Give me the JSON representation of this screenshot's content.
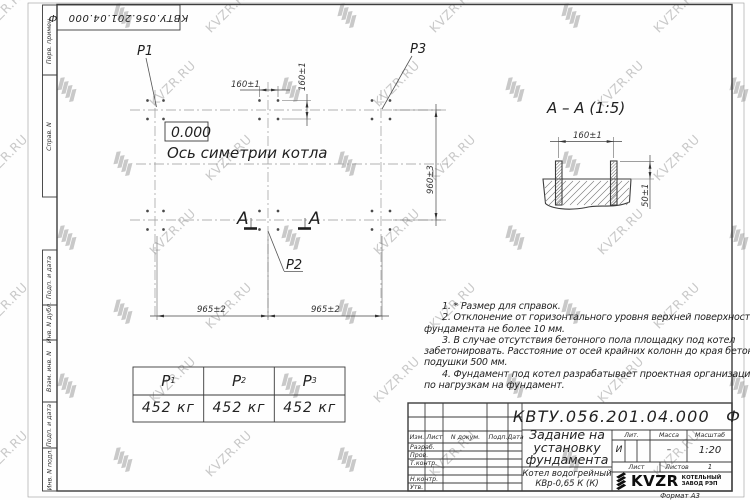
{
  "watermark": {
    "text": "KVZR.RU",
    "color": "#c9c9c9"
  },
  "corner_stamp": {
    "text": "КВТУ.056.201.04.000 Ф"
  },
  "margin": {
    "labels": [
      "Перв. примен.",
      "Справ. N",
      "Подп. и дата",
      "Инв. N дубл.",
      "Взам. инв. N",
      "Подп. и дата",
      "Инв. N подл."
    ]
  },
  "plan": {
    "point_labels": {
      "p1": "P1",
      "p2": "P2",
      "p3": "P3"
    },
    "elevation": "0.000",
    "axis_label": "Ось симетрии котла",
    "dims": {
      "bolt_x": "160±1",
      "bolt_y": "160±1",
      "height": "960±3",
      "span_left": "965±2",
      "span_right": "965±2"
    },
    "section_letter": "A"
  },
  "section_view": {
    "title": "A – A (1:5)",
    "dims": {
      "bolt_spacing": "160±1",
      "protrusion": "50±1"
    }
  },
  "notes": {
    "lines": [
      {
        "text": "1. * Размер для справок.",
        "indent": true
      },
      {
        "text": "2. Отклонение от горизонтального уровня верхней поверхности",
        "indent": true
      },
      {
        "text": "фундамента не более 10 мм.",
        "indent": false
      },
      {
        "text": "3. В случае отсутствия бетонного пола площадку под котел",
        "indent": true
      },
      {
        "text": "забетонировать. Расстояние от осей крайних колонн до края бетонной",
        "indent": false
      },
      {
        "text": "подушки 500 мм.",
        "indent": false
      },
      {
        "text": "4. Фундамент под котел разрабатывает проектная организация",
        "indent": true
      },
      {
        "text": "по нагрузкам на фундамент.",
        "indent": false
      }
    ]
  },
  "load_table": {
    "headers": [
      {
        "base": "P",
        "sub": "1"
      },
      {
        "base": "P",
        "sub": "2"
      },
      {
        "base": "P",
        "sub": "3"
      }
    ],
    "values": [
      "452 кг",
      "452 кг",
      "452 кг"
    ]
  },
  "title_block": {
    "designation": "КВТУ.056.201.04.000 Ф",
    "doc_title_lines": [
      "Задание на",
      "установку",
      "фундамента"
    ],
    "product_lines": [
      "Котел водогрейный",
      "КВр-0,65 К (К)"
    ],
    "labels": {
      "izm": "Изм.",
      "list": "Лист",
      "n_doc": "N докум.",
      "podp": "Подп.",
      "data": "Дата",
      "razrab": "Разраб.",
      "prov": "Пров.",
      "tkontr": "Т.контр.",
      "nkontr": "Н.контр.",
      "utv": "Утв.",
      "lit": "Лит.",
      "massa": "Масса",
      "masshtab": "Масштаб",
      "list2": "Лист",
      "listov": "Листов"
    },
    "values": {
      "lit": "И",
      "massa": "–",
      "scale": "1:20",
      "sheets": "1"
    },
    "logo": {
      "text": "KVZR",
      "caption_lines": [
        "КОТЕЛЬНЫЙ",
        "ЗАВОД РЭП"
      ]
    },
    "format": "Формат А3"
  }
}
